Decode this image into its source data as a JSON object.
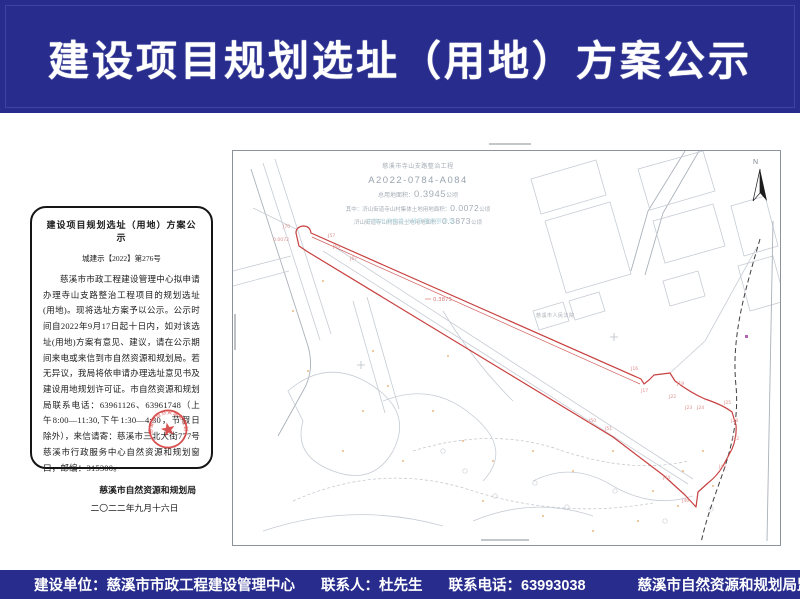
{
  "header": {
    "title": "建设项目规划选址（用地）方案公示"
  },
  "notice": {
    "title": "建设项目规划选址（用地）方案公示",
    "doc_no": "城建示【2022】第276号",
    "body": "慈溪市市政工程建设管理中心拟申请办理寺山支路整治工程项目的规划选址(用地)。现将选址方案予以公示。公示时间自2022年9月17日起十日内，如对该选址(用地)方案有意见、建议，请在公示期间来电或来信到市自然资源和规划局。若无异议，我局将依申请办理选址意见书及建设用地规划许可证。市自然资源和规划局联系电话：63961126、63961748（上午8:00—11:30,下午1:30—4:30，节假日除外），来信请寄：慈溪市三北大街777号慈溪市行政服务中心自然资源和规划窗口，邮编：315300。",
    "signature": "慈溪市自然资源和规划局",
    "date": "二〇二二年九月十六日",
    "seal_text": "慈溪市自然资源和规划局"
  },
  "map": {
    "project_name": "慈溪市寺山支路整治工程",
    "project_no": "A2022-0784-A084",
    "area_total_label": "总用地面积：",
    "area_total": "0.3945",
    "area_unit": "公顷",
    "area_sub1_label": "其中：浒山街道寺山村集体土地用地面积：",
    "area_sub1": "0.0072",
    "area_sub2_label": "浒山街道寺山村国有土地用地面积：",
    "area_sub2": "0.3873",
    "watermark": "宁波市测绘设计研究院有限公司",
    "north_label": "N",
    "court_label": "慈溪市人民法院",
    "parcel_area_label": "0.3873",
    "parcel_start_label": "0.0072",
    "point_labels": [
      {
        "t": "J70",
        "x": 50,
        "y": 77
      },
      {
        "t": "0.0072",
        "x": 40,
        "y": 90
      },
      {
        "t": "J57",
        "x": 95,
        "y": 86
      },
      {
        "t": "J64",
        "x": 100,
        "y": 97
      },
      {
        "t": "J67",
        "x": 117,
        "y": 109
      },
      {
        "t": "J16",
        "x": 398,
        "y": 219
      },
      {
        "t": "J17",
        "x": 408,
        "y": 241
      },
      {
        "t": "J19",
        "x": 444,
        "y": 234
      },
      {
        "t": "J22",
        "x": 436,
        "y": 247
      },
      {
        "t": "J23",
        "x": 452,
        "y": 258
      },
      {
        "t": "J24",
        "x": 464,
        "y": 258
      },
      {
        "t": "J25",
        "x": 491,
        "y": 253
      },
      {
        "t": "J28",
        "x": 498,
        "y": 271
      },
      {
        "t": "J42",
        "x": 499,
        "y": 289
      },
      {
        "t": "J43",
        "x": 486,
        "y": 317
      },
      {
        "t": "J44",
        "x": 430,
        "y": 328
      },
      {
        "t": "J46",
        "x": 449,
        "y": 351
      },
      {
        "t": "J50",
        "x": 356,
        "y": 271
      },
      {
        "t": "J51",
        "x": 372,
        "y": 279
      }
    ]
  },
  "footer": {
    "builder": "建设单位：慈溪市市政工程建设管理中心",
    "contact": "联系人：杜先生",
    "phone": "联系电话：63993038",
    "supervisor": "慈溪市自然资源和规划局监制",
    "date": "2022年9月16日"
  },
  "colors": {
    "band_navy": "#282d8d",
    "parcel_red": "#c84040",
    "seal_red": "#d43b3b"
  }
}
